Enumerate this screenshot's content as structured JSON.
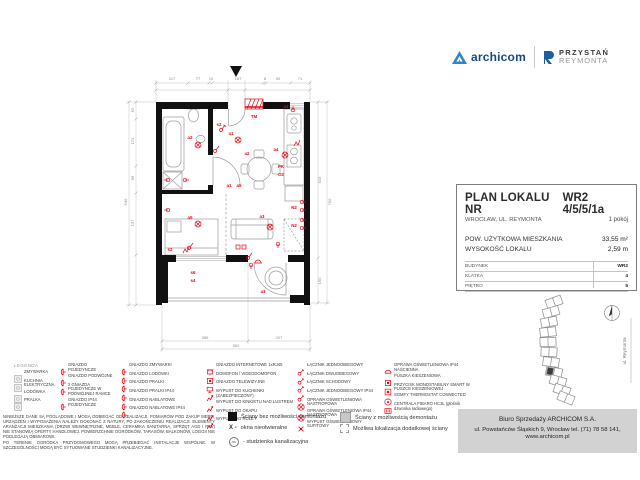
{
  "brand": {
    "archicom": "archicom",
    "project_line1": "PRZYSTAŃ",
    "project_line2": "REYMONTA"
  },
  "info_panel": {
    "title": "PLAN LOKALU NR",
    "unit_number": "WR2 4/5/5/1a",
    "address": "WROCŁAW, UL. REYMONTA",
    "rooms": "1 pokój",
    "area_label": "POW. UŻYTKOWA MIESZKANIA",
    "area_value": "33,55 m²",
    "height_label": "WYSOKOŚĆ LOKALU",
    "height_value": "2,59 m",
    "table": [
      {
        "label": "BUDYNEK",
        "value": "WR2"
      },
      {
        "label": "KLATKA",
        "value": "4"
      },
      {
        "label": "PIĘTRO",
        "value": "5"
      }
    ]
  },
  "site_map": {
    "street_label": "ul. Reymonta"
  },
  "plan": {
    "annotations": [
      {
        "t": "TM",
        "x": 166,
        "y": 66
      },
      {
        "t": "s2",
        "x": 131,
        "y": 74
      },
      {
        "t": "a2",
        "x": 102,
        "y": 87
      },
      {
        "t": "a1",
        "x": 143,
        "y": 83
      },
      {
        "t": "a3",
        "x": 198,
        "y": 56
      },
      {
        "t": "a4",
        "x": 188,
        "y": 99
      },
      {
        "t": "PK",
        "x": 193,
        "y": 116
      },
      {
        "t": "O2",
        "x": 193,
        "y": 124
      },
      {
        "t": "N2",
        "x": 206,
        "y": 157
      },
      {
        "t": "N2",
        "x": 206,
        "y": 175
      },
      {
        "t": "a2",
        "x": 159,
        "y": 103
      },
      {
        "t": "a1",
        "x": 141,
        "y": 135
      },
      {
        "t": "a5",
        "x": 151,
        "y": 135
      },
      {
        "t": "a5",
        "x": 102,
        "y": 167
      },
      {
        "t": "a3",
        "x": 174,
        "y": 166
      },
      {
        "t": "s2",
        "x": 82,
        "y": 199
      },
      {
        "t": "s6",
        "x": 105,
        "y": 222
      },
      {
        "t": "s4",
        "x": 105,
        "y": 230
      },
      {
        "t": "a3",
        "x": 175,
        "y": 241
      }
    ],
    "dims_top": [
      "117",
      "77",
      "10",
      "187",
      "8",
      "90",
      "71"
    ],
    "dims_left": [
      "62",
      "171",
      "99",
      "137"
    ],
    "dims_left_total": "540",
    "dims_right": [
      "519",
      "150"
    ],
    "dims_right_total": "750",
    "dims_bottom": [
      "355",
      "207"
    ],
    "dims_bottom_total": "562"
  },
  "legend": {
    "title": "LEGENDA",
    "columns": [
      {
        "items": [
          {
            "icon": "sq",
            "label": "ZMYWARKA"
          },
          {
            "icon": "sq",
            "label": "KUCHNIA ELEKTRYCZNA"
          },
          {
            "icon": "sq",
            "label": "LODÓWKA"
          },
          {
            "icon": "sq",
            "label": "PRALKA"
          }
        ]
      },
      {
        "items": [
          {
            "icon": "socket",
            "label": "GNIAZDO POJEDYNCZE"
          },
          {
            "icon": "socket",
            "label": "GNIAZDO PODWÓJNE"
          },
          {
            "icon": "socket",
            "label": "2 GNIAZDA POJEDYNCZE W PODWÓJNEJ RAMCE"
          },
          {
            "icon": "socket",
            "label": "GNIAZDO IP44 POJEDYNCZE"
          }
        ]
      },
      {
        "items": [
          {
            "icon": "socket",
            "label": "GNIAZDO ZMYWARKI"
          },
          {
            "icon": "socket",
            "label": "GNIAZDO LODÓWKI"
          },
          {
            "icon": "socket",
            "label": "GNIAZDO PRALKI"
          },
          {
            "icon": "socket",
            "label": "GNIAZDO PRALKI IP44"
          },
          {
            "icon": "socket",
            "label": "GNIAZDO NABLATOWE"
          },
          {
            "icon": "socket",
            "label": "GNIAZDO NABLATOWE IP44"
          }
        ]
      },
      {
        "items": [
          {
            "icon": "net",
            "label": "GNIAZDO INTERNETOWE 1xRJ45"
          },
          {
            "icon": "box",
            "label": "DOMOFON / VIDEODOMOFON"
          },
          {
            "icon": "tv",
            "label": "GNIAZDO TELEWIZYJNE"
          },
          {
            "icon": "arrow",
            "label": "WYPUST DO KUCHENKI (ZABEZPIECZONY)"
          },
          {
            "icon": "arrow",
            "label": "WYPUST DO KINKIETU NAD LUSTREM"
          },
          {
            "icon": "arrow",
            "label": "WYPUST DO OKAPU"
          },
          {
            "icon": "arrow",
            "label": "WYPUST DO ROLET"
          }
        ]
      },
      {
        "items": [
          {
            "icon": "switch",
            "label": "ŁĄCZNIK JEDNOOBIEGOWY"
          },
          {
            "icon": "switch",
            "label": "ŁĄCZNIK DWUOBIEGOWY"
          },
          {
            "icon": "switch",
            "label": "ŁĄCZNIK SCHODOWY"
          },
          {
            "icon": "switch",
            "label": "ŁĄCZNIK JEDNOOBIEGOWY IP44"
          },
          {
            "icon": "lamp",
            "label": "OPRAWA OŚWIETLENIOWA NASTROPOWA"
          },
          {
            "icon": "lamp",
            "label": "OPRAWA OŚWIETLENIOWA IP44 NASTROPOWA"
          },
          {
            "icon": "lampx",
            "label": "WYPUST OŚWIETLENIOWY SUFITOWY"
          }
        ]
      },
      {
        "items": [
          {
            "icon": "wall",
            "label": "OPRAWA OŚWIETLENIOWA IP44 NAŚCIENNA"
          },
          {
            "icon": "box",
            "label": "PUSZKA KIESZENIOWA"
          },
          {
            "icon": "btn",
            "label": "PRZYCISK MONOSTABILNY SMART W PUSZCE KIESZENIOWEJ"
          },
          {
            "icon": "therm",
            "label": "SOMFY THERMOSTAT CONNECTED"
          },
          {
            "icon": "hub",
            "label": "CENTRALA FIBARO HC3L (głośnik dzwonka radiowego)"
          }
        ]
      }
    ],
    "walls": [
      {
        "label": "Ściany bez możliwości demontażu"
      },
      {
        "label": "okna nieotwieralne",
        "prefix": "X -"
      },
      {
        "label": "- studzienka kanalizacyjna",
        "badge": "ss"
      },
      {
        "label": "Ściany z możliwością demontażu"
      },
      {
        "label": "Możliwa lokalizacja dodatkowej ściany"
      }
    ]
  },
  "disclaimer": {
    "p1": "NINIEJSZE DANE SĄ POGLĄDOWE I MOGĄ ODBIEGAĆ OD REALIZACJI. POMIARÓW POD ZAKUP MEBLI, URZĄDZEŃ I WYPOSAŻENIA NALEŻY DOKONAĆ Z NATURY, PO ZAKOŃCZENIU REALIZACJI. ELEMENTY ARANŻACJI MIESZKANIA (DRZWI WEWNĘTRZNE, MEBLE, CERAMIKA SANITARNA, SPRZĘT AGD I RTV) NIE STANOWIĄ OFERTY HANDLOWEJ. POWIERZCHNIE OGRÓDKÓW, TARASÓW, BALKONÓW, LOGGII NIE PODLEGAJĄ OBMIAROWI.",
    "p2": "PO TERENIE OGRÓDKA PRZYDOMOWEGO MOGĄ PRZEBIEGAĆ INSTALACJE WSPÓLNE. W SZCZEGÓLNOŚCI MOGĄ BYĆ SYTUOWANE STUDZIENKI KANALIZACYJNE."
  },
  "address_box": {
    "line1": "Biuro Sprzedaży ARCHICOM S.A.",
    "line2": "ul. Powstańców Śląskich 9, Wrocław  tel. (71) 78 58 141,",
    "line3": "www.archicom.pl"
  },
  "colors": {
    "accent_red": "#e30613",
    "brand_blue": "#2e86c8",
    "brand_navy": "#174a7c"
  }
}
